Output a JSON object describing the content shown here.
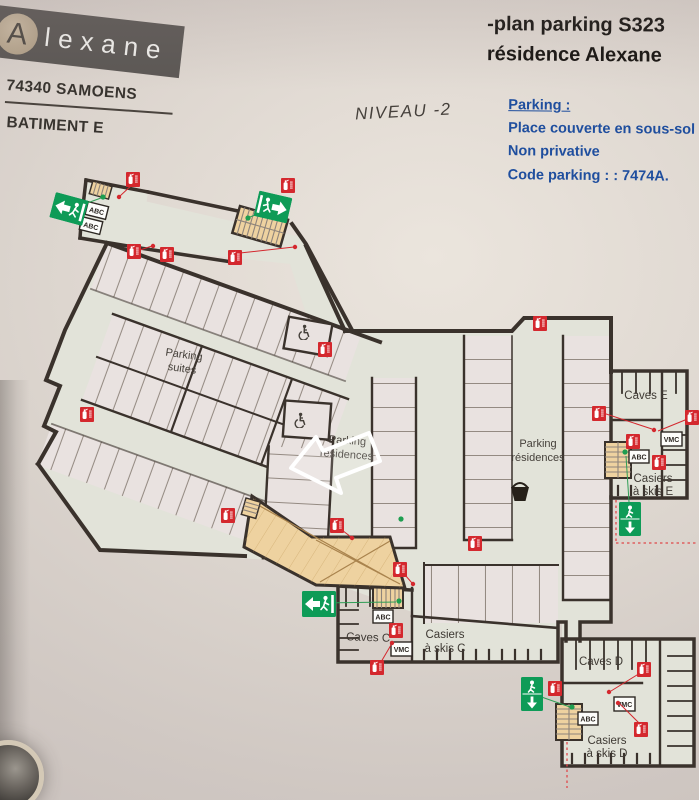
{
  "header": {
    "logo_mark": "A",
    "logo_text": "lexane",
    "address": "74340 SAMOENS",
    "building": "BATIMENT E"
  },
  "title": {
    "line1": "-plan parking S323",
    "line2": "résidence Alexane"
  },
  "level_label": "NIVEAU -2",
  "info": {
    "heading": "Parking :",
    "lines": [
      "Place couverte en sous-sol",
      "Non privative",
      "Code parking : : 7474A."
    ]
  },
  "plan": {
    "labels": {
      "parking_suites_1": "Parking",
      "parking_suites_2": "suites",
      "parking_res_mid_1": "Parking",
      "parking_res_mid_2": "résidences",
      "parking_res_right_1": "Parking",
      "parking_res_right_2": "résidences",
      "caves_e": "Caves E",
      "casiers_e_1": "Casiers",
      "casiers_e_2": "à skis E",
      "caves_c": "Caves C",
      "casiers_c_1": "Casiers",
      "casiers_c_2": "à skis C",
      "caves_d": "Caves D",
      "casiers_d_1": "Casiers",
      "casiers_d_2": "à skis D"
    },
    "equipment": {
      "vmc": "VMC",
      "abc": "ABC"
    },
    "colors": {
      "wall": "#3a322c",
      "floor": "#e2e3d9",
      "parking_space": "#e9e2e0",
      "stairs_ramp": "#eed2a0",
      "safety_red": "#d4282e",
      "exit_green": "#0e9b57",
      "info_blue": "#1f4e9e"
    }
  }
}
